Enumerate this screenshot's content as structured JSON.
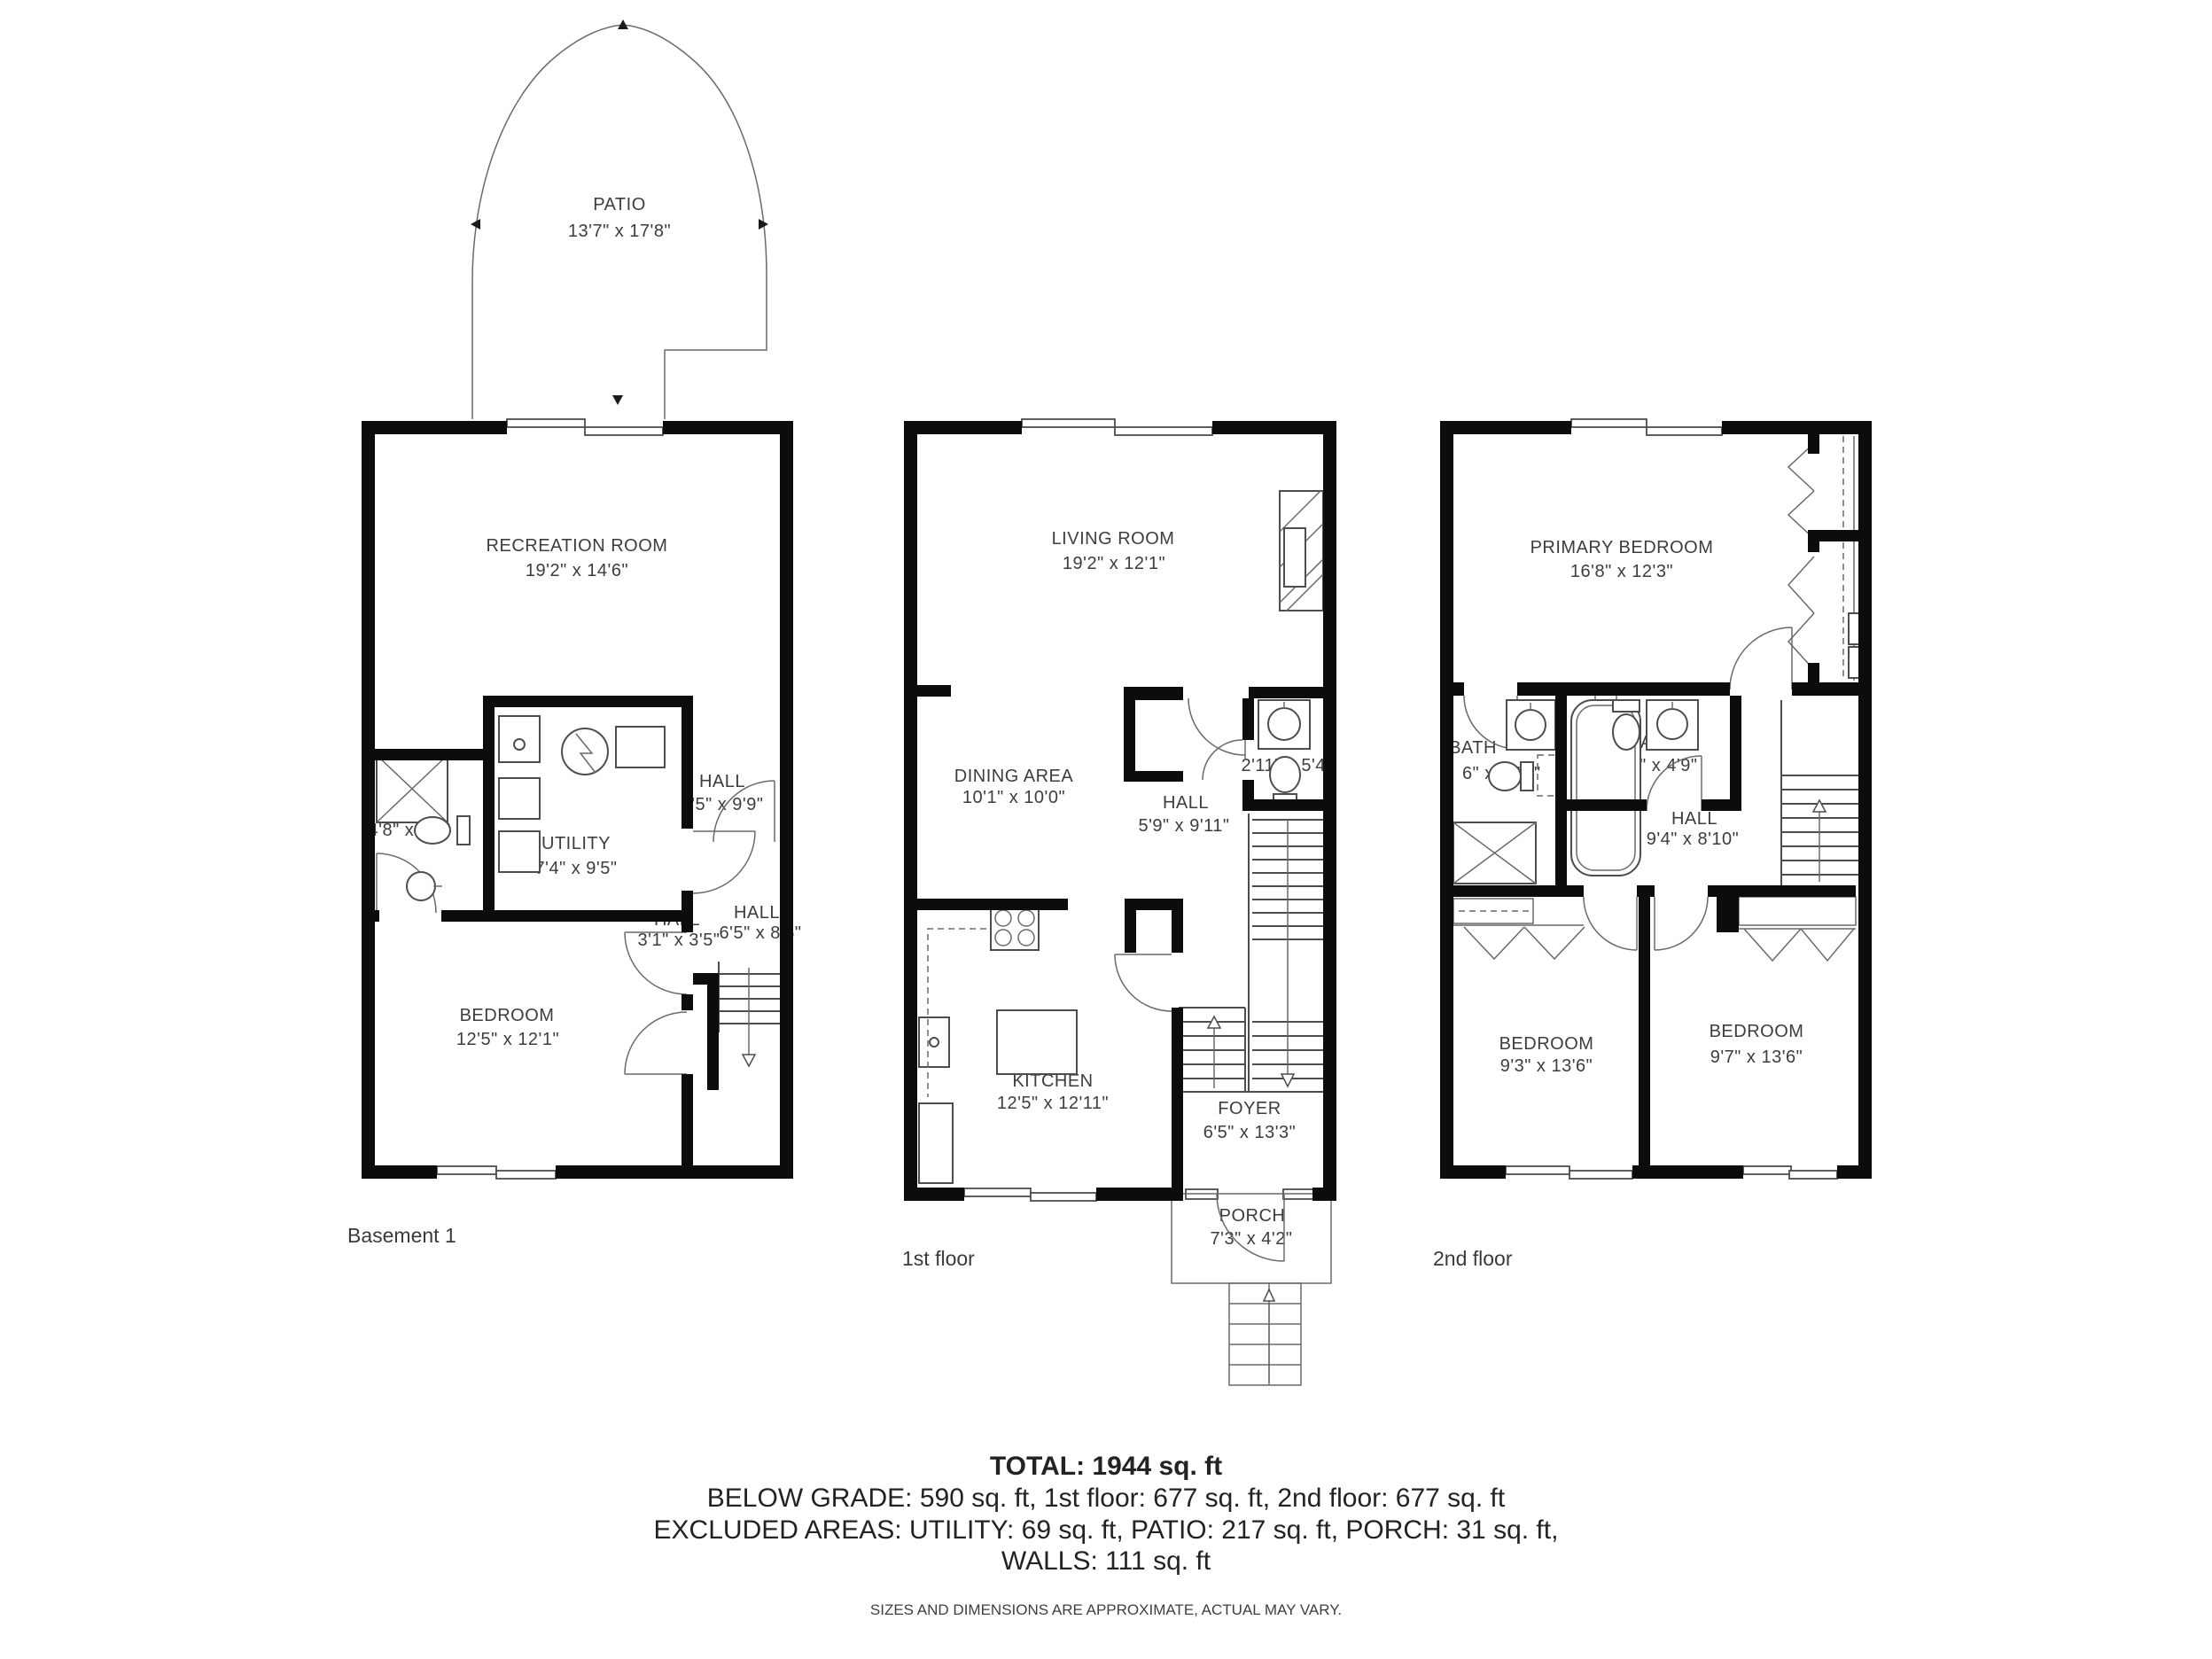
{
  "floors": [
    {
      "label": "Basement 1",
      "outdoor": {
        "name": "PATIO",
        "dims": "13'7\" x 17'8\""
      },
      "rooms": [
        {
          "name": "RECREATION ROOM",
          "dims": "19'2\" x 14'6\""
        },
        {
          "name": "BATH",
          "dims": "4'8\" x 7'1\""
        },
        {
          "name": "UTILITY",
          "dims": "7'4\" x 9'5\""
        },
        {
          "name": "HALL",
          "dims": "6'5\" x 9'9\""
        },
        {
          "name": "HALL",
          "dims": "3'1\" x 3'5\""
        },
        {
          "name": "HALL",
          "dims": "6'5\" x 8'5\""
        },
        {
          "name": "BEDROOM",
          "dims": "12'5\" x 12'1\""
        }
      ]
    },
    {
      "label": "1st floor",
      "rooms": [
        {
          "name": "LIVING ROOM",
          "dims": "19'2\" x 12'1\""
        },
        {
          "name": "DINING AREA",
          "dims": "10'1\" x 10'0\""
        },
        {
          "name": "BATH",
          "dims": "2'11\" x 5'4\""
        },
        {
          "name": "HALL",
          "dims": "5'9\" x 9'11\""
        },
        {
          "name": "KITCHEN",
          "dims": "12'5\" x 12'11\""
        },
        {
          "name": "FOYER",
          "dims": "6'5\" x 13'3\""
        },
        {
          "name": "PORCH",
          "dims": "7'3\" x 4'2\""
        }
      ]
    },
    {
      "label": "2nd floor",
      "rooms": [
        {
          "name": "PRIMARY BEDROOM",
          "dims": "16'8\" x 12'3\""
        },
        {
          "name": "BATH",
          "dims": "6\" x 8'10\""
        },
        {
          "name": "BATH",
          "dims": "7'6\" x 4'9\""
        },
        {
          "name": "HALL",
          "dims": "9'4\" x 8'10\""
        },
        {
          "name": "BEDROOM",
          "dims": "9'3\" x 13'6\""
        },
        {
          "name": "BEDROOM",
          "dims": "9'7\" x 13'6\""
        }
      ]
    }
  ],
  "summary": {
    "total": "TOTAL: 1944 sq. ft",
    "line1": "BELOW GRADE: 590 sq. ft, 1st floor: 677 sq. ft, 2nd floor: 677 sq. ft",
    "line2": "EXCLUDED AREAS: UTILITY: 69 sq. ft, PATIO: 217 sq. ft, PORCH: 31 sq. ft,",
    "line3": "WALLS: 111 sq. ft",
    "disclaimer": "SIZES AND DIMENSIONS ARE APPROXIMATE, ACTUAL MAY VARY."
  },
  "colors": {
    "wall": "#0c0c0c",
    "line": "#4d4d4d",
    "text": "#3d3d3d"
  }
}
